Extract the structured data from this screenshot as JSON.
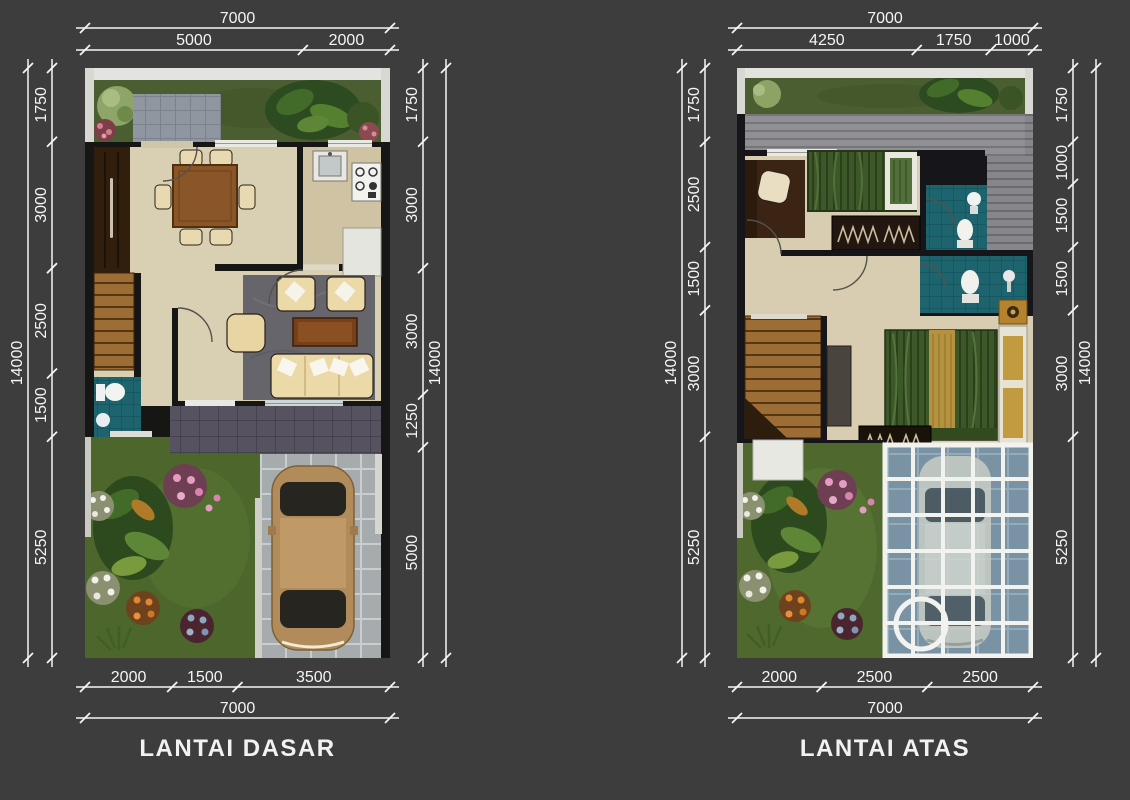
{
  "sheet": {
    "background": "#3d3d3e",
    "line_color": "#f5f5f5",
    "text_color": "#f2f2f2"
  },
  "palette": {
    "wall": "#161614",
    "floor_cream": "#d9cfb3",
    "grass_green": "#4b5e31",
    "bath_teal": "#1d646e",
    "stair_wood": "#9c6d35",
    "rug_gray": "#66656b",
    "terrace_tile": "#56525f",
    "driveway_gray": "#a6abae",
    "car_tan": "#b18b59",
    "sofa_cream": "#ecd9a8",
    "bed_green": "#3d5828",
    "glass_blue": "#7f96a6",
    "roof_gray": "#87878b"
  },
  "plans": [
    {
      "title": "LANTAI DASAR",
      "dimensions": {
        "top": {
          "total": 7000,
          "segments": [
            5000,
            2000
          ]
        },
        "bottom": {
          "total": 7000,
          "segments": [
            2000,
            1500,
            3500
          ]
        },
        "left": {
          "total": 14000,
          "segments": [
            1750,
            3000,
            2500,
            1500,
            5250
          ]
        },
        "right": {
          "total": 14000,
          "segments": [
            1750,
            3000,
            3000,
            1250,
            5000
          ]
        }
      },
      "features": [
        "front-garden",
        "entry-porch",
        "dining-room",
        "kitchen",
        "living-room",
        "staircase",
        "bathroom",
        "cabinet",
        "terrace",
        "rear-garden",
        "driveway",
        "car"
      ]
    },
    {
      "title": "LANTAI ATAS",
      "dimensions": {
        "top": {
          "total": 7000,
          "segments": [
            4250,
            1750,
            1000
          ]
        },
        "bottom": {
          "total": 7000,
          "segments": [
            2000,
            2500,
            2500
          ]
        },
        "left": {
          "total": 14000,
          "segments": [
            1750,
            2500,
            1500,
            3000,
            5250
          ]
        },
        "right": {
          "total": 14000,
          "segments": [
            1750,
            1000,
            1500,
            1500,
            3000,
            5250
          ]
        }
      },
      "features": [
        "roof",
        "bedroom-1",
        "bathroom-1",
        "hall",
        "bathroom-2",
        "staircase",
        "master-bedroom",
        "wardrobe",
        "garden",
        "glass-canopy-carport"
      ]
    }
  ]
}
